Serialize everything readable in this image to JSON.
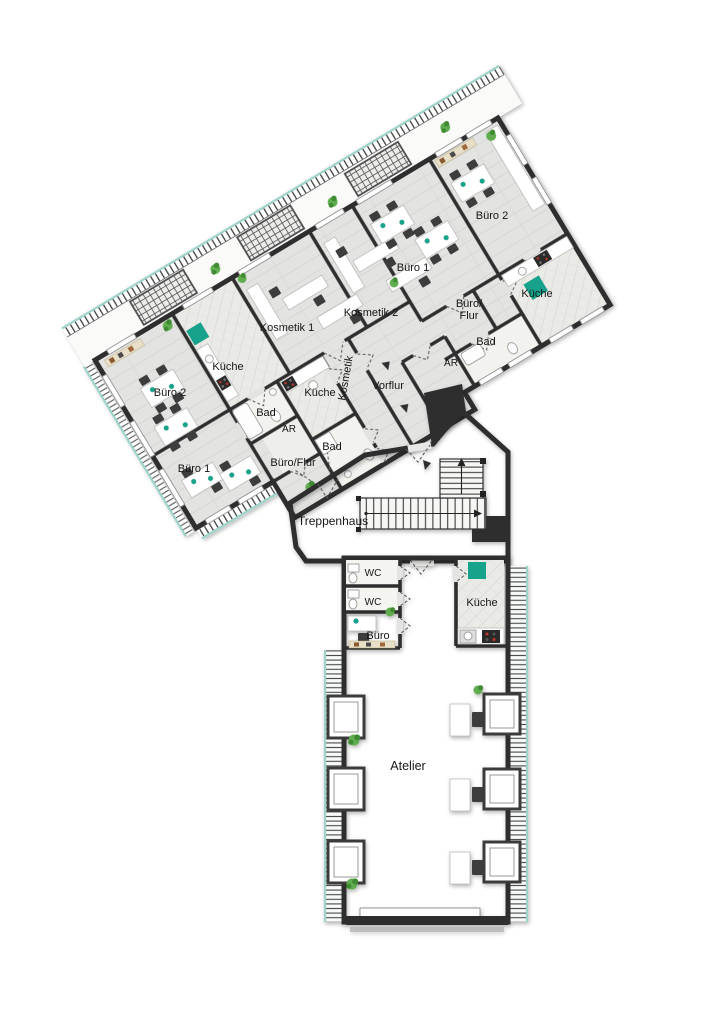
{
  "colors": {
    "wall": "#2d2d2d",
    "accent": "#17a28b",
    "plant": "#61ad4f",
    "tint": "#9ed3ca",
    "text": "#161616"
  },
  "rooms": [
    {
      "id": "buero-2-links",
      "label": "Büro 2"
    },
    {
      "id": "kueche-links",
      "label": "Küche"
    },
    {
      "id": "buero-1-links",
      "label": "Büro 1"
    },
    {
      "id": "bad-links",
      "label": "Bad"
    },
    {
      "id": "ar-links",
      "label": "AR"
    },
    {
      "id": "bueroflur-links",
      "label": "Büro/Flur"
    },
    {
      "id": "kosmetik-1",
      "label": "Kosmetik 1"
    },
    {
      "id": "kueche-mitte",
      "label": "Küche"
    },
    {
      "id": "bad-mitte",
      "label": "Bad"
    },
    {
      "id": "kosmetik-2",
      "label": "Kosmetik 2"
    },
    {
      "id": "kosmetik-flur",
      "label": "Kosmetik"
    },
    {
      "id": "vorflur",
      "label": "Vorflur"
    },
    {
      "id": "ar-rechts",
      "label": "AR"
    },
    {
      "id": "bad-rechts",
      "label": "Bad"
    },
    {
      "id": "bueroflur-rechts",
      "label_line1": "Büro/",
      "label_line2": "Flur"
    },
    {
      "id": "buero-1-rechts",
      "label": "Büro 1"
    },
    {
      "id": "buero-2-rechts",
      "label": "Büro 2"
    },
    {
      "id": "kueche-rechts",
      "label": "Küche"
    },
    {
      "id": "treppenhaus",
      "label": "Treppenhaus"
    },
    {
      "id": "wc-1",
      "label": "WC"
    },
    {
      "id": "wc-2",
      "label": "WC"
    },
    {
      "id": "buero-unten",
      "label": "Büro"
    },
    {
      "id": "kueche-unten",
      "label": "Küche"
    },
    {
      "id": "atelier",
      "label": "Atelier"
    }
  ]
}
